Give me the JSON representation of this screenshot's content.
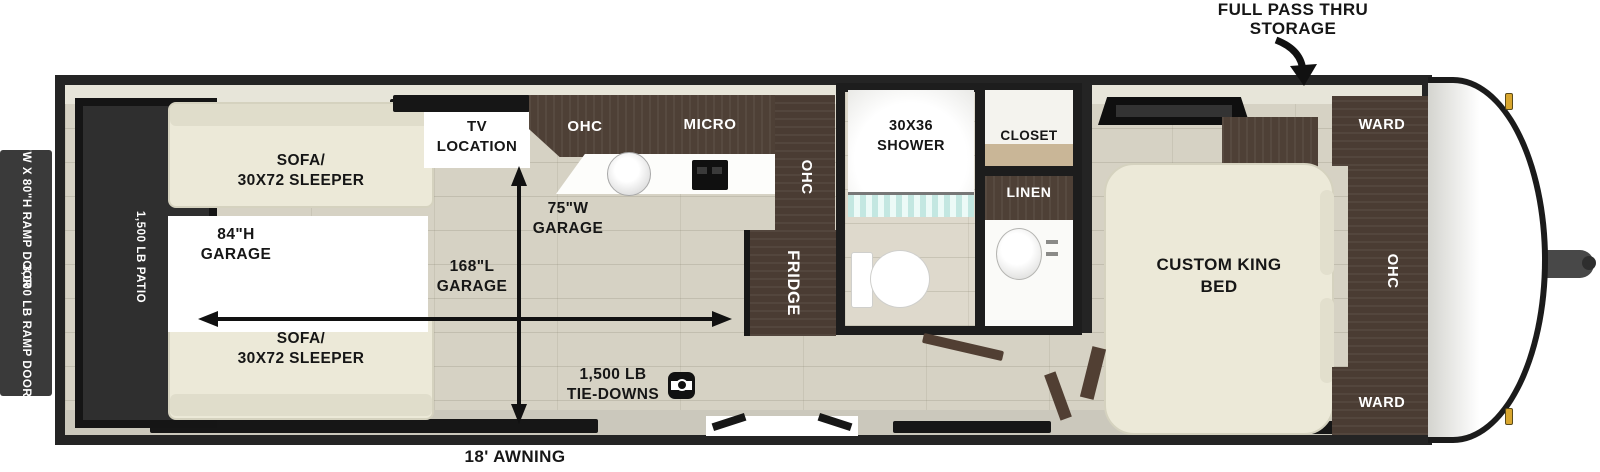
{
  "exterior": {
    "storage_callout_line1": "FULL PASS THRU",
    "storage_callout_line2": "STORAGE",
    "awning_label": "18' AWNING",
    "ramp_door_size_label": "90\"W X 80\"H RAMP DOOR",
    "ramp_door_capacity_label": "3,000 LB RAMP DOOR"
  },
  "garage": {
    "patio_label": "1,500 LB PATIO",
    "sofa_top_line1": "SOFA/",
    "sofa_top_line2": "30X72 SLEEPER",
    "sofa_bottom_line1": "SOFA/",
    "sofa_bottom_line2": "30X72 SLEEPER",
    "height_line1": "84\"H",
    "height_line2": "GARAGE",
    "width_line1": "75\"W",
    "width_line2": "GARAGE",
    "length_line1": "168\"L",
    "length_line2": "GARAGE",
    "tie_downs_line1": "1,500 LB",
    "tie_downs_line2": "TIE-DOWNS",
    "tv_line1": "TV",
    "tv_line2": "LOCATION"
  },
  "kitchen": {
    "ohc_label": "OHC",
    "micro_label": "MICRO",
    "ohc_side_label": "OHC",
    "fridge_label": "FRIDGE"
  },
  "bathroom": {
    "shower_line1": "30X36",
    "shower_line2": "SHOWER",
    "closet_label": "CLOSET",
    "linen_label": "LINEN"
  },
  "bedroom": {
    "bed_line1": "CUSTOM KING",
    "bed_line2": "BED",
    "ward_top_label": "WARD",
    "ward_bottom_label": "WARD",
    "ohc_label": "OHC"
  },
  "colors": {
    "outline": "#242424",
    "floor": "#d6d2c4",
    "cabinet_wood": "#4e4036",
    "cushion": "#ece9d8",
    "patio_dark": "#2f2f2f",
    "shower_curtain": "#c3e7e1",
    "marker_light": "#d9a62e"
  }
}
